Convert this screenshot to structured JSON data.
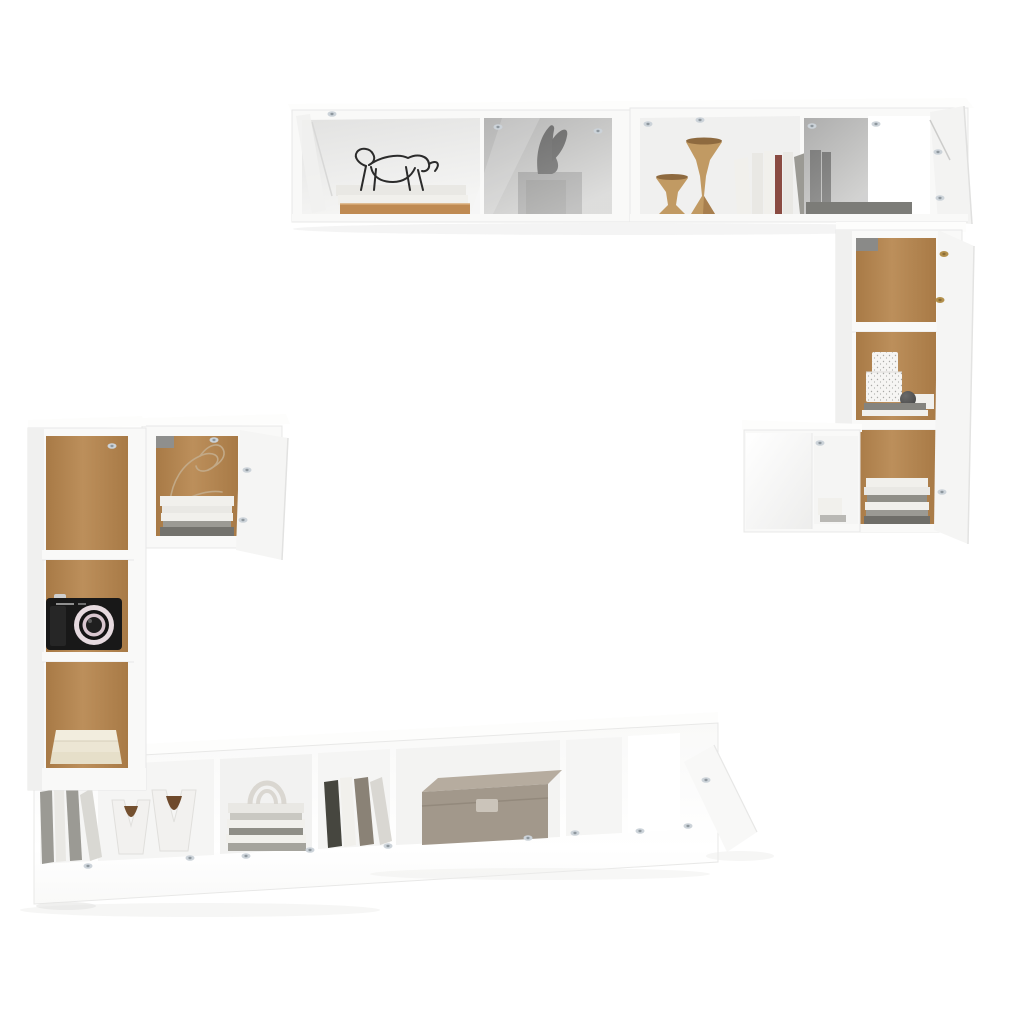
{
  "scene": {
    "caption": "Product photo of a white high-gloss wall-mounted TV cabinet set (hanging wall cabinets, tall side cabinets with oak back panels, low TV bench) decorated with books, vases, a camera and storage boxes on a plain white background",
    "background_color": "#ffffff"
  },
  "furniture": [
    {
      "id": "wall-cabinet-top-left",
      "desc": "horizontal wall cabinet with open shelf and smoked-glass door"
    },
    {
      "id": "wall-cabinet-top-right",
      "desc": "horizontal wall cabinet with open shelf, smoked-glass section and open door"
    },
    {
      "id": "wall-cabinet-right-tall",
      "desc": "tall wall cabinet with oak back panels, two shelves, door open"
    },
    {
      "id": "wall-cabinet-right-small",
      "desc": "small wall cabinet with closed door and open side compartment"
    },
    {
      "id": "wall-cabinet-left-small",
      "desc": "small wall cabinet with oak back panel, door open"
    },
    {
      "id": "wall-cabinet-left-tall",
      "desc": "tall narrow wall cabinet with oak back panels and three compartments"
    },
    {
      "id": "tv-bench",
      "desc": "long low TV bench with open compartments and open right door"
    }
  ],
  "decor": [
    {
      "id": "wire-horse-sculpture",
      "location": "top-left cabinet, standing on book stack"
    },
    {
      "id": "book-stack-top-left",
      "location": "top-left cabinet open shelf"
    },
    {
      "id": "bird-sculpture",
      "location": "behind smoked glass, top-left cabinet"
    },
    {
      "id": "wooden-candlesticks",
      "location": "top-right cabinet open shelf"
    },
    {
      "id": "book-row",
      "location": "top-right cabinet open shelf"
    },
    {
      "id": "dark-books",
      "location": "behind smoked glass, top-right cabinet"
    },
    {
      "id": "speckled-boxes",
      "location": "right tall cabinet, middle shelf"
    },
    {
      "id": "decor-sphere",
      "location": "right tall cabinet, middle shelf"
    },
    {
      "id": "magazine-stack-right",
      "location": "right tall cabinet, bottom shelf"
    },
    {
      "id": "small-white-box",
      "location": "right small cabinet compartment"
    },
    {
      "id": "wire-art-sketch",
      "location": "left small cabinet"
    },
    {
      "id": "magazine-stack-left",
      "location": "left small cabinet"
    },
    {
      "id": "compact-camera",
      "location": "left tall cabinet, middle compartment"
    },
    {
      "id": "paper-stack",
      "location": "left tall cabinet, bottom compartment"
    },
    {
      "id": "leaning-books",
      "location": "TV bench, far left compartment"
    },
    {
      "id": "v-shaped-vases",
      "location": "TV bench, second compartment"
    },
    {
      "id": "stacked-books-with-arch",
      "location": "TV bench, third compartment"
    },
    {
      "id": "upright-books",
      "location": "TV bench, fourth compartment"
    },
    {
      "id": "fabric-storage-box",
      "location": "TV bench, fifth compartment"
    }
  ],
  "colors": {
    "background": "#ffffff",
    "cabinet_white": "#f9f9f8",
    "cabinet_side": "#f0f0ef",
    "top_face": "#fdfdfc",
    "door_white": "#f5f5f4",
    "interior_light": "#f5f5f4",
    "interior_bright": "#ffffff",
    "interior_gray": "#e2e2e1",
    "edge_line": "#e8e8e7",
    "soft_shadow": "#ededec",
    "wood_dark": "#a87a46",
    "wood_mid": "#bc8f5b",
    "glass_dark": "#9f9f9f",
    "glass_mid": "#c7c7c6",
    "glass_light": "#e9e9e8",
    "wire_black": "#2b2b2b",
    "wire_tan": "#c2a987",
    "book_tan": "#bf8a52",
    "book_white": "#f1f0ec",
    "book_cream": "#e9e8e4",
    "book_gray": "#9b9a94",
    "book_gray_dark": "#8f8e87",
    "book_red": "#8a4b42",
    "book_dark": "#46463f",
    "candle_wood": "#c19a63",
    "candle_wood_dark": "#8e6a3f",
    "bird_dark": "#262626",
    "pedestal_gray": "#8a8a8a",
    "board_gray": "#7c7c78",
    "sphere_dark": "#3f3f3f",
    "speckle_base": "#f6f5f3",
    "speckle_dot": "#a9a9a6",
    "camera_black": "#181818",
    "camera_grip": "#262626",
    "lens_ring_outer": "#e6dadf",
    "lens_ring_inner": "#d9c6cf",
    "lens_dark": "#141414",
    "paper_cream": "#ece6d4",
    "paper_cream2": "#f2edde",
    "vase_white": "#f2f1ef",
    "vase_bowl_brown": "#74502f",
    "arch_white": "#dad7d1",
    "box_top": "#b6ac9f",
    "box_front": "#a2988b",
    "box_plate": "#cbc4ba",
    "hinge_silver": "#ccd3d9",
    "hinge_silver_dark": "#8e979e",
    "hinge_brass": "#b3904c"
  }
}
